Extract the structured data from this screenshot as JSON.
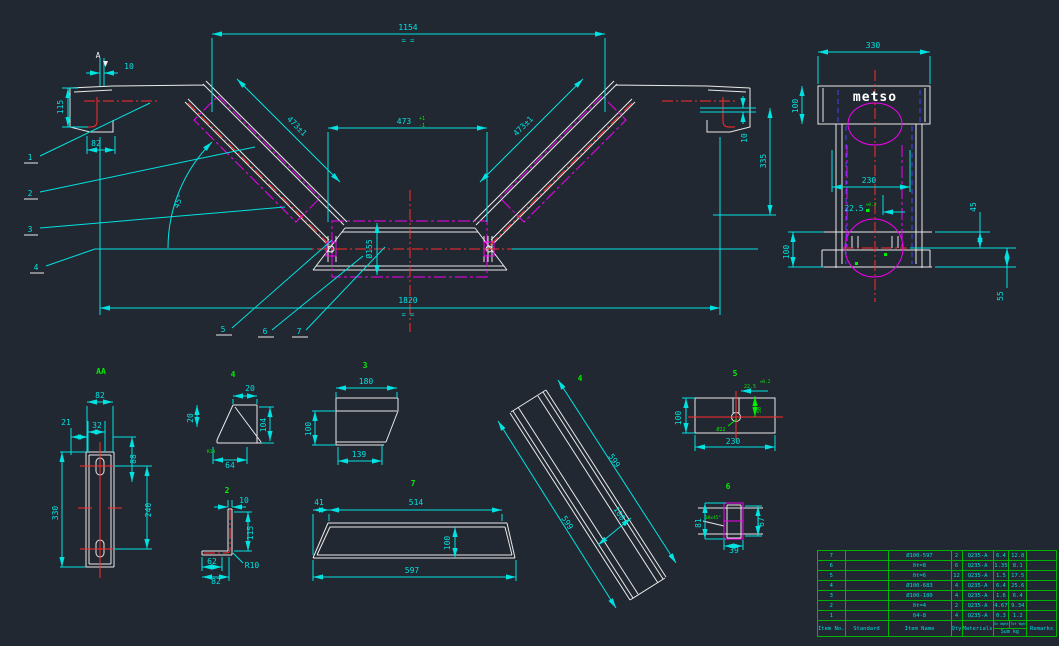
{
  "mv": {
    "amark": "A",
    "d1154": "1154",
    "eq1": "= =",
    "d473l": "473±1",
    "d473c": "473",
    "tolu": "+1",
    "told": "-1",
    "d473r": "473±1",
    "d10l": "10",
    "d115": "115",
    "d82": "82",
    "dang": "45°",
    "dphi": "Ø155",
    "d1820": "1820",
    "eq2": "= =",
    "d10r": "10",
    "d335": "335",
    "b1": "1",
    "b2": "2",
    "b3": "3",
    "b4": "4",
    "b5": "5",
    "b6": "6",
    "b7": "7"
  },
  "sv": {
    "brand": "metso",
    "d330": "330",
    "d100t": "100",
    "d230": "230",
    "d225": "22.5",
    "tolu": "+0.2",
    "told": "0",
    "d100b": "100",
    "d45": "45",
    "d55": "55"
  },
  "dt": {
    "aa": {
      "lbl": "AA",
      "d82": "82",
      "d32": "32",
      "d21": "21",
      "d88": "88",
      "d330": "330",
      "d240": "240"
    },
    "p4s": {
      "lbl": "4",
      "d20t": "20",
      "d104": "104",
      "d64": "64",
      "d20l": "20",
      "note": "R10"
    },
    "p3": {
      "lbl": "3",
      "d180": "180",
      "d139": "139",
      "d100": "100"
    },
    "p2": {
      "lbl": "2",
      "d10": "10",
      "d115": "115",
      "d62": "62",
      "d82": "82",
      "r": "R10"
    },
    "p7": {
      "lbl": "7",
      "d41": "41",
      "d514": "514",
      "d100": "100",
      "d597": "597"
    },
    "p4f": {
      "lbl": "4",
      "d599a": "599",
      "d599b": "599",
      "d100": "100"
    },
    "p5": {
      "lbl": "5",
      "d100": "100",
      "d230": "230",
      "d225": "22.5",
      "tol": "+0.2",
      "d50": "50",
      "hole": "Ø22"
    },
    "p6": {
      "lbl": "6",
      "d81": "81",
      "d67": "67",
      "d39": "39",
      "note": "10x45°"
    }
  },
  "table": {
    "headers": {
      "item_no": "Item No.",
      "standard": "Standard",
      "item_name": "Item Name",
      "qty": "Qty",
      "materials": "Materials",
      "unit_weight": "Un Wght",
      "total_weight": "Tot Wght",
      "sum": "Sum kg",
      "remarks": "Remarks"
    },
    "rows": [
      {
        "no": "7",
        "standard": "",
        "name": "Ø100-597",
        "qty": "2",
        "material": "Q235-A",
        "unit": "6.4",
        "total": "12.8",
        "remarks": ""
      },
      {
        "no": "6",
        "standard": "",
        "name": "δt=8",
        "qty": "6",
        "material": "Q235-A",
        "unit": "1.35",
        "total": "8.1",
        "remarks": ""
      },
      {
        "no": "5",
        "standard": "",
        "name": "δt=6",
        "qty": "12",
        "material": "Q235-A",
        "unit": "1.5",
        "total": "17.5",
        "remarks": ""
      },
      {
        "no": "4",
        "standard": "",
        "name": "Ø100-683",
        "qty": "4",
        "material": "Q235-A",
        "unit": "6.4",
        "total": "25.6",
        "remarks": ""
      },
      {
        "no": "3",
        "standard": "",
        "name": "Ø100-180",
        "qty": "4",
        "material": "Q235-A",
        "unit": "1.6",
        "total": "6.4",
        "remarks": ""
      },
      {
        "no": "2",
        "standard": "",
        "name": "δt=4",
        "qty": "2",
        "material": "Q235-A",
        "unit": "4.67",
        "total": "9.34",
        "remarks": ""
      },
      {
        "no": "1",
        "standard": "",
        "name": "δ4-8",
        "qty": "4",
        "material": "Q235-A",
        "unit": "0.3",
        "total": "1.2",
        "remarks": ""
      }
    ]
  },
  "colors": {
    "background": "#222831",
    "geometry": "#e9e9e9",
    "dimension": "#00e2e2",
    "centerline": "#ff2b2b",
    "phantom": "#f400f4",
    "hidden": "#4343ff",
    "label": "#00ee00",
    "table_grid": "#00b400"
  }
}
